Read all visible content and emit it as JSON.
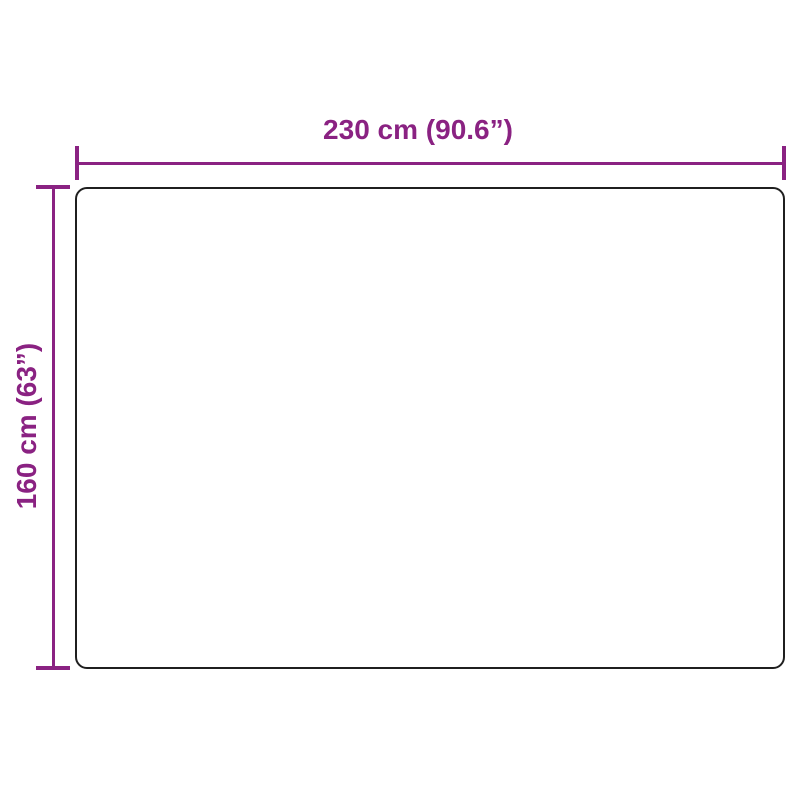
{
  "diagram": {
    "title": "product-size-diagram",
    "width_dimension": {
      "label": "230 cm (90.6”)",
      "value_cm": 230,
      "value_inch": 90.6
    },
    "height_dimension": {
      "label": "160 cm (63”)",
      "value_cm": 160,
      "value_inch": 63
    }
  },
  "colors": {
    "accent": "#8a2282",
    "outline": "#1f1f1f",
    "background": "#ffffff"
  }
}
